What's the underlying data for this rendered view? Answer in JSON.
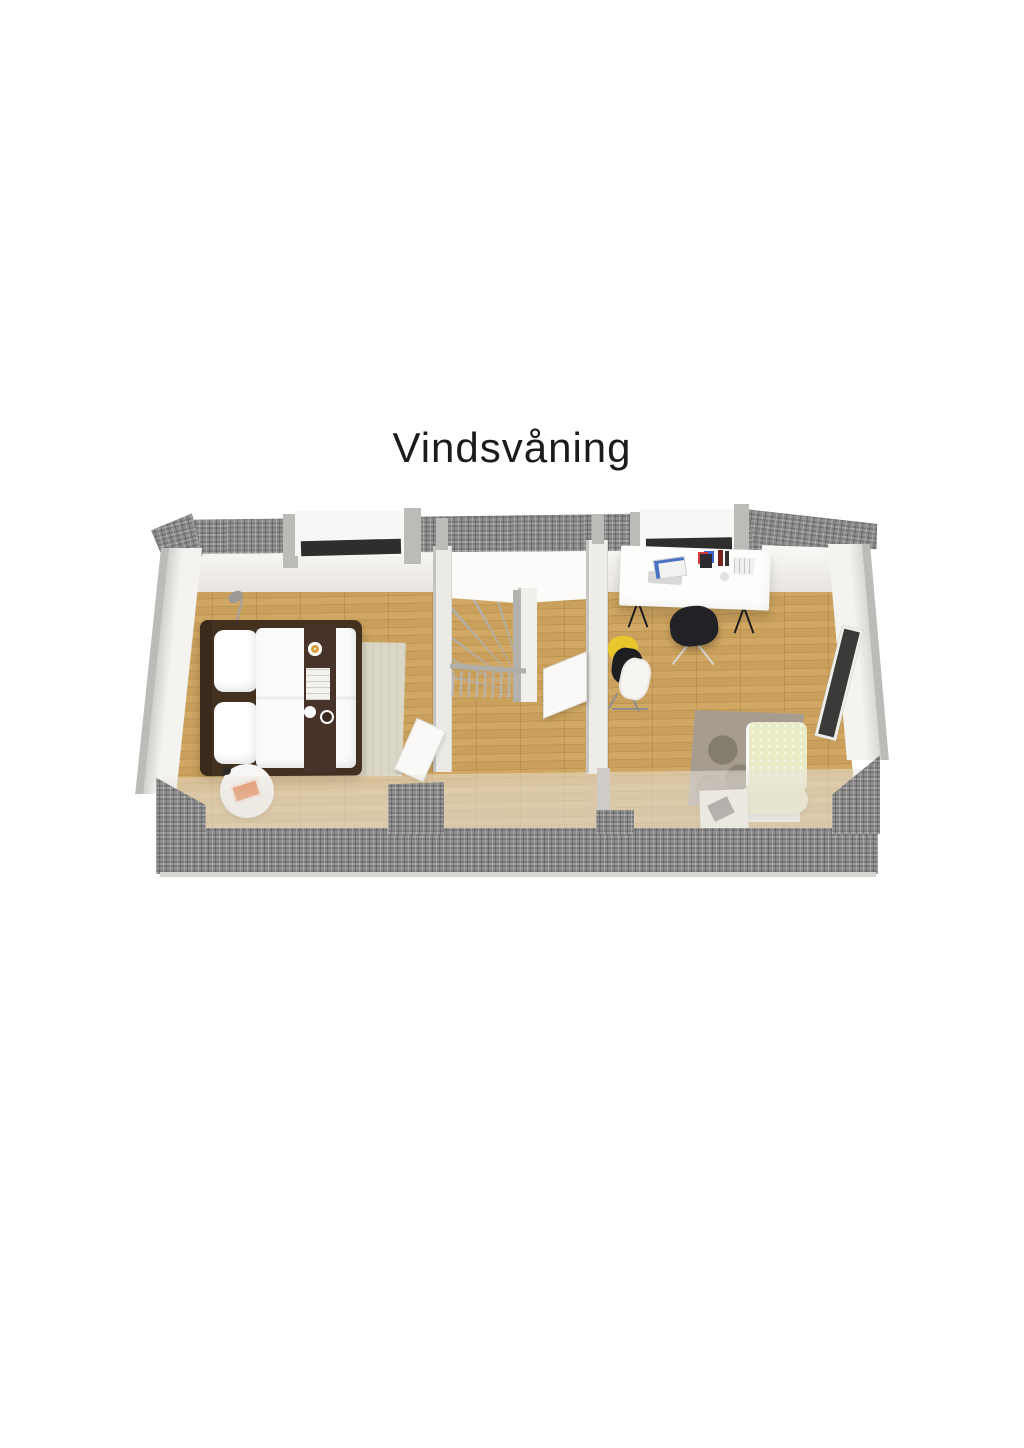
{
  "title": "Vindsvåning",
  "scene": {
    "type": "3d-floorplan-top-view",
    "floor_name": "Vindsvåning",
    "rooms": [
      {
        "name": "bedroom",
        "furniture": [
          "double-bed",
          "dark-bed-runner",
          "breakfast-tray",
          "pillows",
          "beige-area-rug",
          "round-side-table",
          "orange-magazine",
          "floor-lamp"
        ]
      },
      {
        "name": "stair-hall",
        "furniture": [
          "winder-staircase",
          "stair-railing",
          "newel-post",
          "open-hall-door",
          "open-bedroom-door"
        ]
      },
      {
        "name": "office-bedroom",
        "furniture": [
          "white-desk",
          "laptop",
          "pencil-cup",
          "bottles",
          "book-stack",
          "black-office-chair",
          "clothes-rack",
          "yellow-jacket",
          "patterned-armchair",
          "shaggy-rug",
          "white-side-box"
        ]
      }
    ],
    "exterior": [
      "top-roof-tile-strip",
      "dormer-window-left",
      "dormer-window-right",
      "left-gable-wall",
      "right-gable-wall",
      "gable-window",
      "translucent-roof-plane",
      "tiled-eaves"
    ]
  },
  "colors": {
    "title-text": "#1b1b1b",
    "page-bg": "#ffffff",
    "wall": "#f4f3f0",
    "wall-shade": "#e8e5e0",
    "wall-cap": "#bcbbb8",
    "tile-a": "#9c9c9c",
    "tile-b": "#7b7b7b",
    "tile-c": "#8f8f8f",
    "wood-a": "#d0a763",
    "wood-b": "#bd9551",
    "wood-c": "#c9a05c",
    "bed-frame": "#43301f",
    "linen": "#fbfbfa",
    "runner": "#47332a",
    "rug-beige": "#dbd7c6",
    "magazine-orange": "#e0662a",
    "armchair-green": "#e9ecc6",
    "shag": "#a69d90",
    "chair-black": "#222226",
    "clothes-yellow": "#e8c62c",
    "window-dark": "#3a3a38",
    "sill-dark": "#2f2e2c",
    "ceiling-white": "#fcfbf9"
  }
}
